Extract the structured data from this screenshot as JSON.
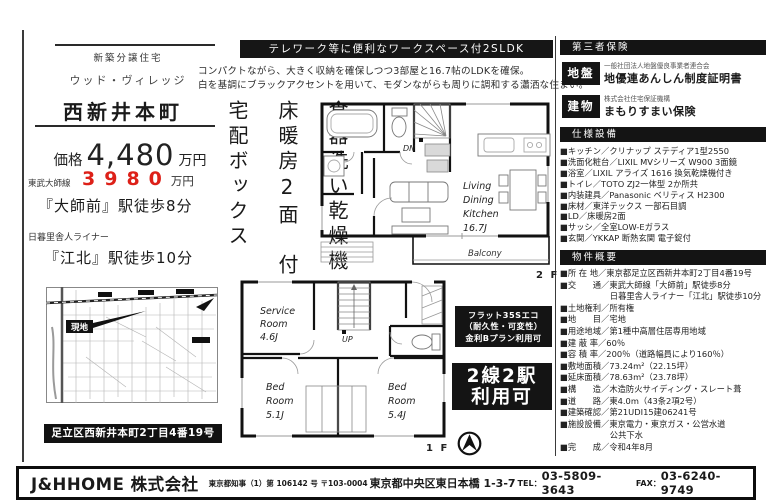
{
  "left": {
    "property_type": "新築分譲住宅",
    "project_name": "ウッド・ヴィレッジ",
    "town_name": "西新井本町",
    "price_label": "価格",
    "price_value": "4,480",
    "price_unit": "万円",
    "sale_price": "3980",
    "sale_price_unit": "万円",
    "rail1_line": "東武大師線",
    "rail1_station": "『大師前』駅徒歩8分",
    "rail2_line": "日暮里舎人ライナー",
    "rail2_station": "『江北』駅徒歩10分",
    "map_site_label": "現地",
    "address_bar": "足立区西新井本町2丁目4番19号"
  },
  "center": {
    "banner": "テレワーク等に便利なワークスペース付2SLDK",
    "desc_line1": "コンパクトながら、大きく収納を確保しつつ3部屋と16.7帖のLDKを確保。",
    "desc_line2": "白を基調にブラックアクセントを用いて、モダンながらも周りに調和する瀟洒な住まい。",
    "features_vertical": [
      "食器洗い乾燥機",
      "床暖房2面　付",
      "宅配ボックス"
    ],
    "flat35_lines": [
      "フラット35Sエコ",
      "（耐久性・可変性）",
      "金利Bプラン利用可"
    ],
    "access_box_lines": [
      "2線2駅",
      "利用可"
    ]
  },
  "plan2f": {
    "floor_label": "2 F",
    "stairs_label": "DN",
    "room_lines": [
      "Living",
      "Dining",
      "Kitchen",
      "16.7J"
    ],
    "balcony_label": "Balcony"
  },
  "plan1f": {
    "floor_label": "1 F",
    "stairs_label": "UP",
    "service_lines": [
      "Service",
      "Room",
      "4.6J"
    ],
    "bed1_lines": [
      "Bed",
      "Room",
      "5.1J"
    ],
    "bed2_lines": [
      "Bed",
      "Room",
      "5.4J"
    ]
  },
  "right": {
    "warranty_header": "第三者保険",
    "ground": {
      "badge": "地盤",
      "org": "一般社団法人地盤優良事業者連合会",
      "cert": "地優連あんしん制度証明書"
    },
    "building": {
      "badge": "建物",
      "org": "株式会社住宅保証機構",
      "cert": "まもりすまい保険"
    },
    "spec_header": "仕様設備",
    "spec_items": [
      "■キッチン／クリナップ ステディア1型2550",
      "■洗面化粧台／LIXIL MVシリーズ W900 3面鏡",
      "■浴室／LIXIL アライズ 1616 換気乾燥機付き",
      "■トイレ／TOTO ZJ2一体型 2か所共",
      "■内装建具／Panasonic ベリティス H2300",
      "■床材／東洋テックス 一部石目調",
      "■LD／床暖房2面",
      "■サッシ／全室LOW-Eガラス",
      "■玄関／YKKAP 断熱玄関 電子錠付"
    ],
    "overview_header": "物件概要",
    "overview_items": [
      "■所 在 地／東京都足立区西新井本町2丁目4番19号",
      "■交　　通／東武大師線「大師前」駅徒歩8分",
      "　　　　　　日暮里舎人ライナー「江北」駅徒歩10分",
      "■土地権利／所有権",
      "■地　　目／宅地",
      "■用途地域／第1種中高層住居専用地域",
      "■建 蔽 率／60％",
      "■容 積 率／200％（道路幅員により160％）",
      "■敷地面積／73.24m²（22.15坪）",
      "■延床面積／78.63m²（23.78坪）",
      "■構　　造／木造防火サイディング・スレート葺",
      "■道　　路／東4.0m（43条2項2号）",
      "■建築確認／第21UDI15建06241号",
      "■施設設備／東京電力・東京ガス・公営水道",
      "　　　　　　公共下水",
      "■完　　成／令和4年8月"
    ]
  },
  "footer": {
    "company": "J&HHOME 株式会社",
    "license": "東京都知事（1）第 106142 号 〒103-0004",
    "address": "東京都中央区東日本橋 1-3-7",
    "tel_label": "TEL：",
    "tel": "03-5809-3643",
    "fax_label": "FAX：",
    "fax": "03-6240-9749"
  }
}
